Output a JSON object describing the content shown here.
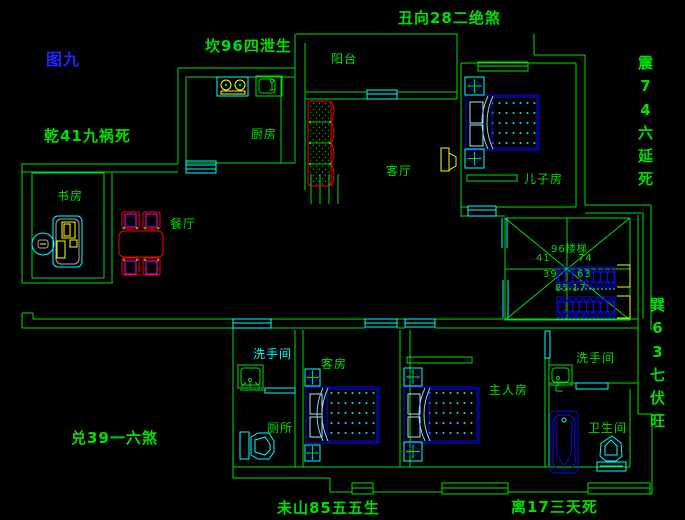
{
  "figure_caption": "图九",
  "annotations": {
    "top_left": "坎96四泄生",
    "top_center": "丑向28二绝煞",
    "left_upper": "乾41九祸死",
    "right_upper_vertical": "震74六延死",
    "right_lower_vertical": "巽63七伏旺",
    "left_lower": "兑39一六煞",
    "bottom_left": "未山85五五生",
    "bottom_right": "离17三天死"
  },
  "rooms": {
    "balcony": "阳台",
    "kitchen": "厨房",
    "living_room": "客厅",
    "study": "书房",
    "dining_room": "餐厅",
    "sons_room": "儿子房",
    "washroom_a": "洗手间",
    "toilet": "厕所",
    "guest_room": "客房",
    "master_room": "主人房",
    "washroom_b": "洗手间",
    "bathroom": "卫生间"
  },
  "stairs": {
    "center_label": "96楼梯",
    "numbers": {
      "nw": "41",
      "ne": "74",
      "w": "39",
      "e": "63",
      "sw": "85",
      "se": "17"
    }
  },
  "colors": {
    "background": "#000000",
    "wall": "#00e000",
    "window_door": "#00ffff",
    "furniture_blue": "#0d0dee",
    "accent_yellow": "#ffff00",
    "sofa_table_red": "#ff0000",
    "chair_magenta": "#ff00ff",
    "text_green": "#00e000",
    "caption_blue": "#2424ff"
  }
}
